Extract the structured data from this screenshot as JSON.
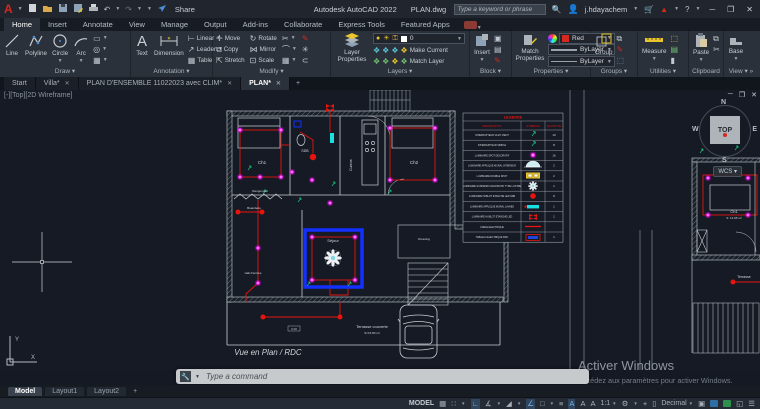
{
  "titlebar": {
    "app_title": "Autodesk AutoCAD 2022",
    "doc_title": "PLAN.dwg",
    "share": "Share",
    "search_placeholder": "Type a keyword or phrase",
    "username": "j.hdayachem"
  },
  "ribbon_tabs": [
    "Home",
    "Insert",
    "Annotate",
    "View",
    "Manage",
    "Output",
    "Add-ins",
    "Collaborate",
    "Express Tools",
    "Featured Apps"
  ],
  "panels": {
    "draw": {
      "label": "Draw",
      "line": "Line",
      "polyline": "Polyline",
      "circle": "Circle",
      "arc": "Arc"
    },
    "annotation": {
      "label": "Annotation",
      "text": "Text",
      "dimension": "Dimension",
      "linear": "Linear",
      "leader": "Leader",
      "table": "Table"
    },
    "modify": {
      "label": "Modify",
      "move": "Move",
      "copy": "Copy",
      "stretch": "Stretch",
      "rotate": "Rotate",
      "mirror": "Mirror",
      "scale": "Scale"
    },
    "layers": {
      "label": "Layers",
      "layer_properties": "Layer Properties",
      "current_layer": "0",
      "make_current": "Make Current",
      "match_layer": "Match Layer"
    },
    "block": {
      "label": "Block",
      "insert": "Insert"
    },
    "properties": {
      "label": "Properties",
      "match_properties": "Match Properties",
      "color": "Red",
      "lineweight": "ByLayer",
      "linetype": "ByLayer"
    },
    "groups": {
      "label": "Groups",
      "group": "Group"
    },
    "utilities": {
      "label": "Utilities",
      "measure": "Measure"
    },
    "clipboard": {
      "label": "Clipboard",
      "paste": "Paste"
    },
    "view": {
      "label": "View",
      "base": "Base"
    }
  },
  "file_tabs": {
    "start": "Start",
    "villa": "Villa*",
    "plan_ensemble": "PLAN D'ENSEMBLE 11022023 avec CLIM*",
    "plan": "PLAN*"
  },
  "viewport": {
    "label": "[-][Top][2D Wireframe]"
  },
  "viewcube": {
    "n": "N",
    "s": "S",
    "e": "E",
    "w": "W",
    "top": "TOP",
    "wcs": "WCS"
  },
  "plan": {
    "rooms": {
      "ch1": "Ch1",
      "sdb": "SDB",
      "cuisine": "Cuisine",
      "ch2": "Ch2",
      "rangement": "Rangement",
      "buanderie": "Buanderie",
      "sejour": "Séjour",
      "hall": "Hall d'entrée",
      "dressing": "Dressing",
      "terrasse_couverte": "Terrasse couverte",
      "terrasse_area": "S=15.80 m²",
      "vue": "Vue en Plan / RDC",
      "dim": "0.00"
    },
    "right": {
      "ch1": "Ch1",
      "ch1_area": "S: 13.95 m²",
      "terrasse": "Terrasse"
    },
    "ucs": {
      "x": "X",
      "y": "Y"
    }
  },
  "legend": {
    "title": "LEGENDE",
    "headers": [
      "DESIGNATION",
      "SYMBOLE",
      "QUANTITE"
    ],
    "rows": [
      {
        "designation": "INTERRUPTEUR VA ET VIENT",
        "qty": "10"
      },
      {
        "designation": "INTERRUPTEUR SIMPLE",
        "qty": "8"
      },
      {
        "designation": "LUMINAIRE SPOT DECORATIF",
        "qty": "16"
      },
      {
        "designation": "LUMINAIRE APPLIQUE MURAL INTERIEUR",
        "qty": "2"
      },
      {
        "designation": "LUMINAIRE DOUBLE SPOT",
        "qty": "2"
      },
      {
        "designation": "LUMINAIRE SUSPENDU DECORATIF TYPE LUSTRE",
        "qty": "1"
      },
      {
        "designation": "LUMINAIRE HUBLOT ETANCHE LED SDB",
        "qty": "8"
      },
      {
        "designation": "LUMINAIRE APPLIQUE MURAL LAVABO",
        "qty": "1"
      },
      {
        "designation": "LUMINAIRE HUBLOT ETANCHE LED",
        "qty": "1"
      },
      {
        "designation": "CABLE ELECTRIQUE",
        "qty": ""
      },
      {
        "designation": "TABLEAU ELECTRIQUE RDC",
        "qty": "1"
      }
    ]
  },
  "watermark": {
    "line1": "Activer Windows",
    "line2": "Accédez aux paramètres pour activer Windows."
  },
  "command_line": {
    "placeholder": "Type a command"
  },
  "layout_tabs": {
    "model": "Model",
    "layout1": "Layout1",
    "layout2": "Layout2"
  },
  "status_bar": {
    "model": "MODEL",
    "scale": "1:1",
    "units": "Decimal"
  },
  "colors": {
    "magenta": "#ff00ff",
    "cable_red": "#e8150f",
    "decor_blue": "#1430ff",
    "cyan": "#18e0e0",
    "accent_red": "#d5281e"
  }
}
